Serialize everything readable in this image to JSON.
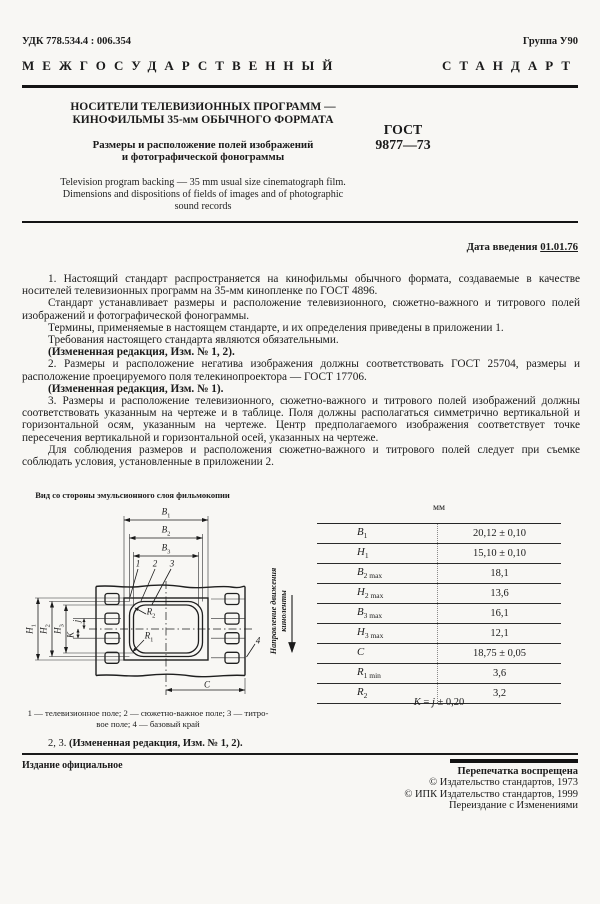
{
  "header": {
    "udk": "УДК 778.534.4 : 006.354",
    "group": "Группа У90",
    "standard_word1": "МЕЖГОСУДАРСТВЕННЫЙ",
    "standard_word2": "СТАНДАРТ"
  },
  "title_block": {
    "title_line1": "НОСИТЕЛИ ТЕЛЕВИЗИОННЫХ ПРОГРАММ —",
    "title_line2": "КИНОФИЛЬМЫ 35-мм ОБЫЧНОГО ФОРМАТА",
    "subtitle_line1": "Размеры и расположение полей изображений",
    "subtitle_line2": "и фотографической фонограммы",
    "english_line1": "Television program backing — 35 mm usual size cinematograph film.",
    "english_line2": "Dimensions and dispositions of fields of images and of photographic",
    "english_line3": "sound records",
    "gost_label": "ГОСТ",
    "gost_number": "9877—73"
  },
  "effective_date": {
    "label": "Дата введения",
    "value": "01.01.76"
  },
  "body": {
    "paragraphs": [
      "1. Настоящий стандарт распространяется на кинофильмы обычного формата, создаваемые в качестве носителей телевизионных программ на 35-мм кинопленке по ГОСТ 4896.",
      "Стандарт устанавливает размеры и расположение телевизионного, сюжетно-важного и титрового полей изображений и фотографической фонограммы.",
      "Термины, применяемые в настоящем стандарте, и их определения приведены в приложении 1.",
      "Требования настоящего стандарта являются обязательными.",
      "(Измененная редакция, Изм. № 1, 2).",
      "2. Размеры и расположение негатива изображения должны соответствовать ГОСТ 25704, размеры и расположение проецируемого поля телекинопроектора — ГОСТ 17706.",
      "(Измененная редакция, Изм. № 1).",
      "3. Размеры и расположение телевизионного, сюжетно-важного и титрового полей изображений должны соответствовать указанным на чертеже и в таблице. Поля должны располагаться симметрично вертикальной и горизонтальной осям, указанным на чертеже. Центр предполагаемого изображения соответствует точке пересечения вертикальной и горизонтальной осей, указанных на чертеже.",
      "Для соблюдения размеров и расположения сюжетно-важного и титрового полей следует при съемке соблюдать условия, установленные в приложении 2."
    ]
  },
  "figure": {
    "caption": "Вид со стороны эмульсионного слоя фильмокопии",
    "direction_line1": "Направление движения",
    "direction_line2": "киноленты",
    "labels": {
      "b": "B",
      "h": "H",
      "r": "R",
      "c": "C",
      "j": "j",
      "k": "K",
      "sub1": "1",
      "sub2": "2",
      "sub3": "3",
      "n1": "1",
      "n2": "2",
      "n3": "3",
      "n4": "4"
    },
    "legend_line1": "1 — телевизионное поле; 2 — сюжетно-важное поле; 3 — титро-",
    "legend_line2": "вое поле; 4 — базовый край"
  },
  "table": {
    "unit_label": "мм",
    "rows": [
      {
        "p": "B",
        "s": "1",
        "v": "20,12 ± 0,10"
      },
      {
        "p": "H",
        "s": "1",
        "v": "15,10 ± 0,10"
      },
      {
        "p": "B",
        "s": "2 max",
        "v": "18,1"
      },
      {
        "p": "H",
        "s": "2 max",
        "v": "13,6"
      },
      {
        "p": "B",
        "s": "3 max",
        "v": "16,1"
      },
      {
        "p": "H",
        "s": "3 max",
        "v": "12,1"
      },
      {
        "p": "C",
        "s": "",
        "v": "18,75 ± 0,05"
      },
      {
        "p": "R",
        "s": "1 min",
        "v": "3,6"
      },
      {
        "p": "R",
        "s": "2",
        "v": "3,2"
      }
    ],
    "note": {
      "k": "K",
      "eq": "=",
      "j": "j",
      "tol": "± 0,20"
    }
  },
  "amendment": {
    "prefix": "2, 3.",
    "text": "(Измененная редакция, Изм. № 1, 2)."
  },
  "footer": {
    "official": "Издание официальное",
    "reprint": "Перепечатка воспрещена",
    "copyright_1973": "© Издательство стандартов, 1973",
    "copyright_1999": "© ИПК Издательство стандартов, 1999",
    "reissue": "Переиздание с Изменениями"
  }
}
